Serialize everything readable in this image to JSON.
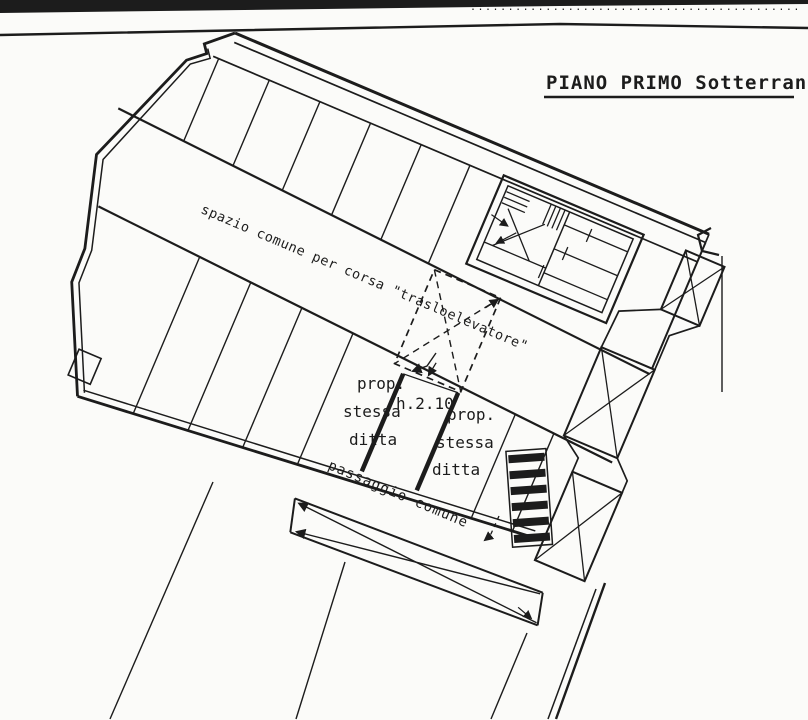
{
  "page": {
    "scan_top_label": "............................................ civ..........",
    "title": "PIANO PRIMO Sotterraneo"
  },
  "plan": {
    "corridor_label": "spazio comune per corsa \"trasloelevatore\"",
    "passage_label": "passaggio  comune",
    "height_label": "h.2.10",
    "left_unit": {
      "line1": "prop.",
      "line2": "stessa",
      "line3": "ditta"
    },
    "right_unit": {
      "line1": "prop.",
      "line2": "stessa",
      "line3": "ditta"
    },
    "ink_color": "#1c1c1c",
    "paper_color": "#fbfbf9"
  }
}
